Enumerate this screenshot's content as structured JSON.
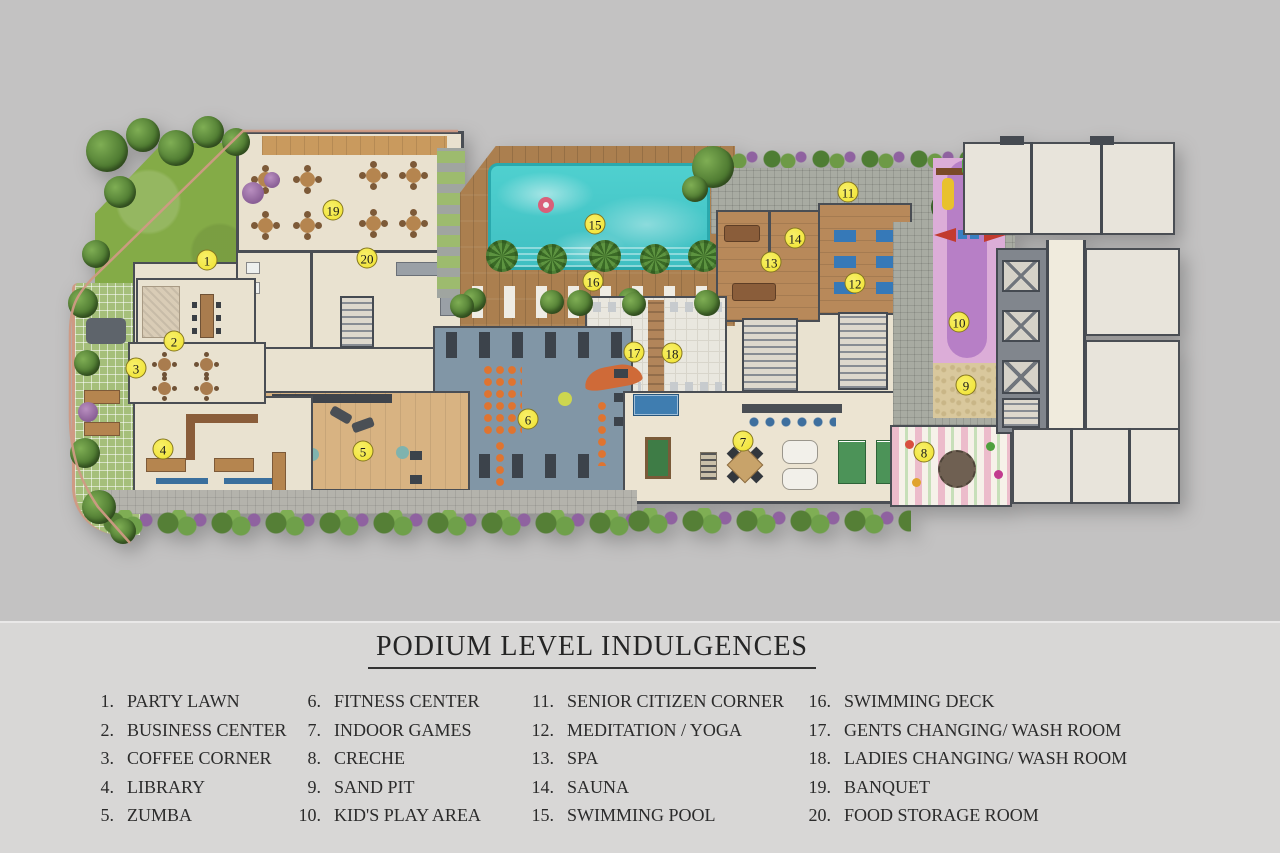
{
  "title": "PODIUM LEVEL INDULGENCES",
  "legend_columns": [
    {
      "items": [
        {
          "num": "1.",
          "label": "PARTY LAWN"
        },
        {
          "num": "2.",
          "label": "BUSINESS CENTER"
        },
        {
          "num": "3.",
          "label": "COFFEE CORNER"
        },
        {
          "num": "4.",
          "label": "LIBRARY"
        },
        {
          "num": "5.",
          "label": "ZUMBA"
        }
      ]
    },
    {
      "items": [
        {
          "num": "6.",
          "label": "FITNESS CENTER"
        },
        {
          "num": "7.",
          "label": "INDOOR GAMES"
        },
        {
          "num": "8.",
          "label": "CRECHE"
        },
        {
          "num": "9.",
          "label": "SAND PIT"
        },
        {
          "num": "10.",
          "label": "KID'S PLAY AREA"
        }
      ]
    },
    {
      "items": [
        {
          "num": "11.",
          "label": "SENIOR CITIZEN CORNER"
        },
        {
          "num": "12.",
          "label": "MEDITATION / YOGA"
        },
        {
          "num": "13.",
          "label": "SPA"
        },
        {
          "num": "14.",
          "label": "SAUNA"
        },
        {
          "num": "15.",
          "label": "SWIMMING POOL"
        }
      ]
    },
    {
      "items": [
        {
          "num": "16.",
          "label": "SWIMMING DECK"
        },
        {
          "num": "17.",
          "label": "GENTS CHANGING/ WASH ROOM"
        },
        {
          "num": "18.",
          "label": "LADIES CHANGING/ WASH ROOM"
        },
        {
          "num": "19.",
          "label": "BANQUET"
        },
        {
          "num": "20.",
          "label": "FOOD STORAGE ROOM"
        }
      ]
    }
  ],
  "markers": [
    {
      "n": "1",
      "x": 207,
      "y": 260
    },
    {
      "n": "2",
      "x": 174,
      "y": 341
    },
    {
      "n": "3",
      "x": 136,
      "y": 368
    },
    {
      "n": "4",
      "x": 163,
      "y": 449
    },
    {
      "n": "5",
      "x": 363,
      "y": 451
    },
    {
      "n": "6",
      "x": 528,
      "y": 419
    },
    {
      "n": "7",
      "x": 743,
      "y": 441
    },
    {
      "n": "8",
      "x": 924,
      "y": 452
    },
    {
      "n": "9",
      "x": 966,
      "y": 385
    },
    {
      "n": "10",
      "x": 959,
      "y": 322
    },
    {
      "n": "11",
      "x": 848,
      "y": 192
    },
    {
      "n": "12",
      "x": 855,
      "y": 283
    },
    {
      "n": "13",
      "x": 771,
      "y": 262
    },
    {
      "n": "14",
      "x": 795,
      "y": 238
    },
    {
      "n": "15",
      "x": 595,
      "y": 224
    },
    {
      "n": "16",
      "x": 593,
      "y": 281
    },
    {
      "n": "17",
      "x": 634,
      "y": 352
    },
    {
      "n": "18",
      "x": 672,
      "y": 353
    },
    {
      "n": "19",
      "x": 333,
      "y": 210
    },
    {
      "n": "20",
      "x": 367,
      "y": 258
    }
  ],
  "colors": {
    "plan_background": "#c3c2c2",
    "legend_background": "#d8d7d6",
    "marker_yellow": "#f0e22e",
    "pool_teal": "#45c8c9",
    "deck_wood": "#ab7f4f",
    "lawn_green": "#84ab47",
    "gym_floor": "#8196a6",
    "kids_pink": "#dcadd8"
  }
}
